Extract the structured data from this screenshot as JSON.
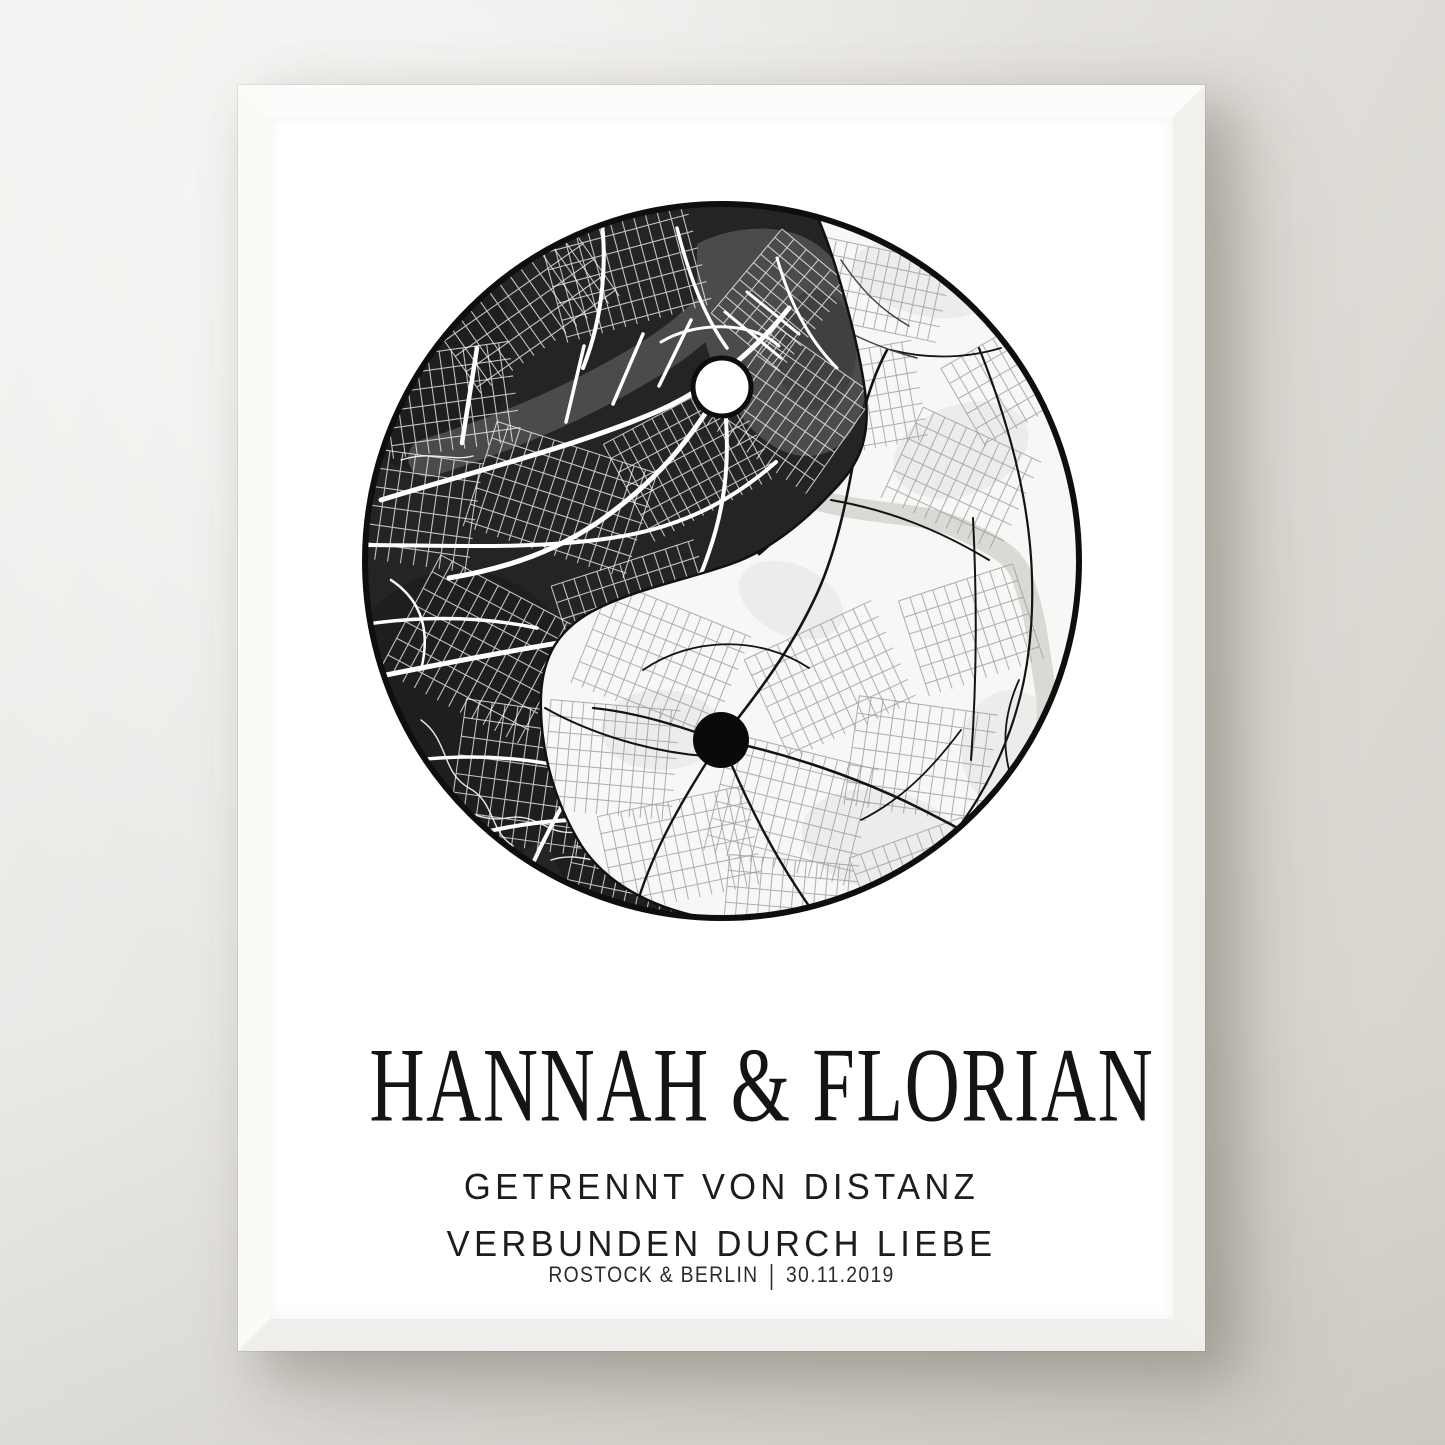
{
  "poster": {
    "title": "HANNAH & FLORIAN",
    "subtitle_line1": "GETRENNT VON DISTANZ",
    "subtitle_line2": "VERBUNDEN DURCH LIEBE",
    "footer": {
      "places": "ROSTOCK & BERLIN",
      "separator": "|",
      "date": "30.11.2019"
    }
  },
  "map": {
    "kind": "yin-yang dual city map",
    "colors": {
      "dark_bg": "#242424",
      "dark_patch": "#1b1b1b",
      "dark_water": "#4b4b4b",
      "dark_road": "#ffffff",
      "light_bg": "#f7f7f5",
      "light_patch": "#ececea",
      "light_water": "#d9d9d6",
      "light_road": "#141414",
      "light_road_minor": "#9a9a9a",
      "outline": "#0e0e0e",
      "marker_on_dark": "#ffffff",
      "marker_on_light": "#0a0a0a"
    }
  }
}
